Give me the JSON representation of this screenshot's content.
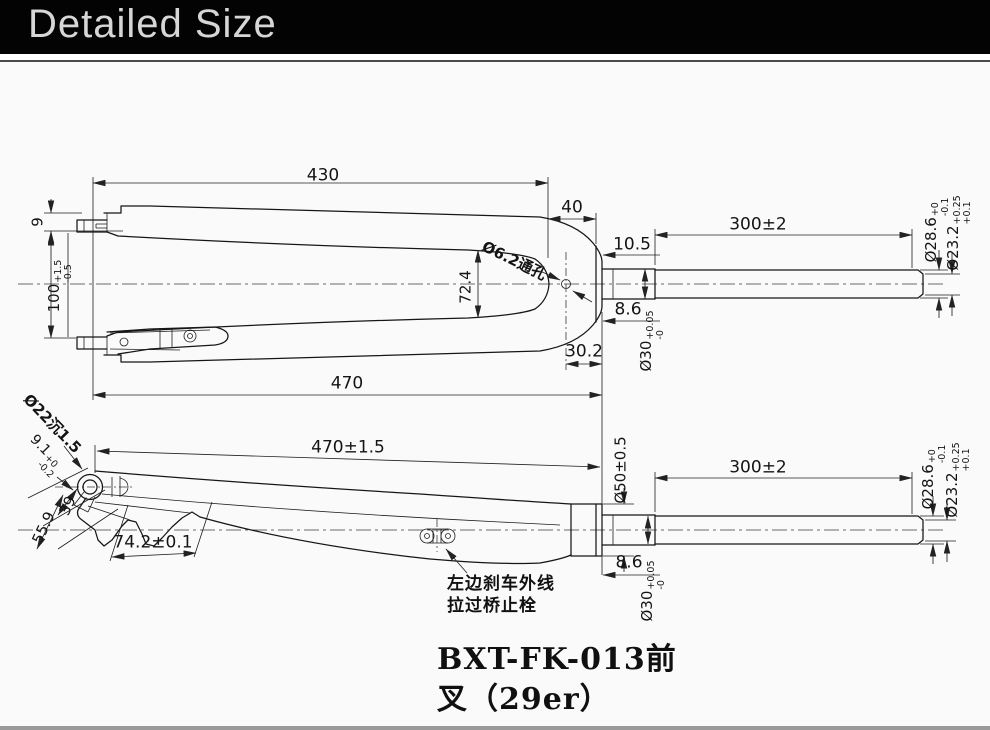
{
  "header": {
    "title": "Detailed Size"
  },
  "title_block": {
    "line1": "BXT-FK-013前",
    "line2": "叉（29er）"
  },
  "colors": {
    "header_bg": "#030303",
    "header_text": "#d6d6d6",
    "canvas": "#fafafa",
    "line": "#161616",
    "footer_strip": "#9a9a9a"
  },
  "top_view": {
    "dim_430": "430",
    "dim_40": "40",
    "dim_300": "300±2",
    "dim_10_5": "10.5",
    "dim_8_6": "8.6",
    "dim_30_2": "30.2",
    "dim_470": "470",
    "dim_72_4": "72.4",
    "dim_9": "9",
    "hole_label": "Ø6.2通孔",
    "dim_100": {
      "base": "100",
      "tol_top": "+1.5",
      "tol_bottom": "-0.5"
    },
    "dim_d30": {
      "base": "Ø30",
      "tol_top": "+0.05",
      "tol_bottom": "-0"
    },
    "dim_d28_6": {
      "base": "Ø28.6",
      "tol_top": "+0",
      "tol_bottom": "-0.1"
    },
    "dim_d23_2": {
      "base": "Ø23.2",
      "tol_top": "+0.25",
      "tol_bottom": "+0.1"
    }
  },
  "side_view": {
    "dim_470": "470±1.5",
    "dim_300": "300±2",
    "dim_d50": "Ø50±0.5",
    "dim_8_6": "8.6",
    "dim_74_2": "74.2±0.1",
    "dim_39": "39",
    "dim_55_9": "55.9",
    "counterbore_label": "Ø22沉1.5",
    "dim_9_1": {
      "base": "9.1",
      "tol_top": "+0",
      "tol_bottom": "-0.2"
    },
    "dim_d30": {
      "base": "Ø30",
      "tol_top": "+0.05",
      "tol_bottom": "-0"
    },
    "dim_d28_6": {
      "base": "Ø28.6",
      "tol_top": "+0",
      "tol_bottom": "-0.1"
    },
    "dim_d23_2": {
      "base": "Ø23.2",
      "tol_top": "+0.25",
      "tol_bottom": "+0.1"
    },
    "brake_note_line1": "左边刹车外线",
    "brake_note_line2": "拉过桥止栓"
  }
}
